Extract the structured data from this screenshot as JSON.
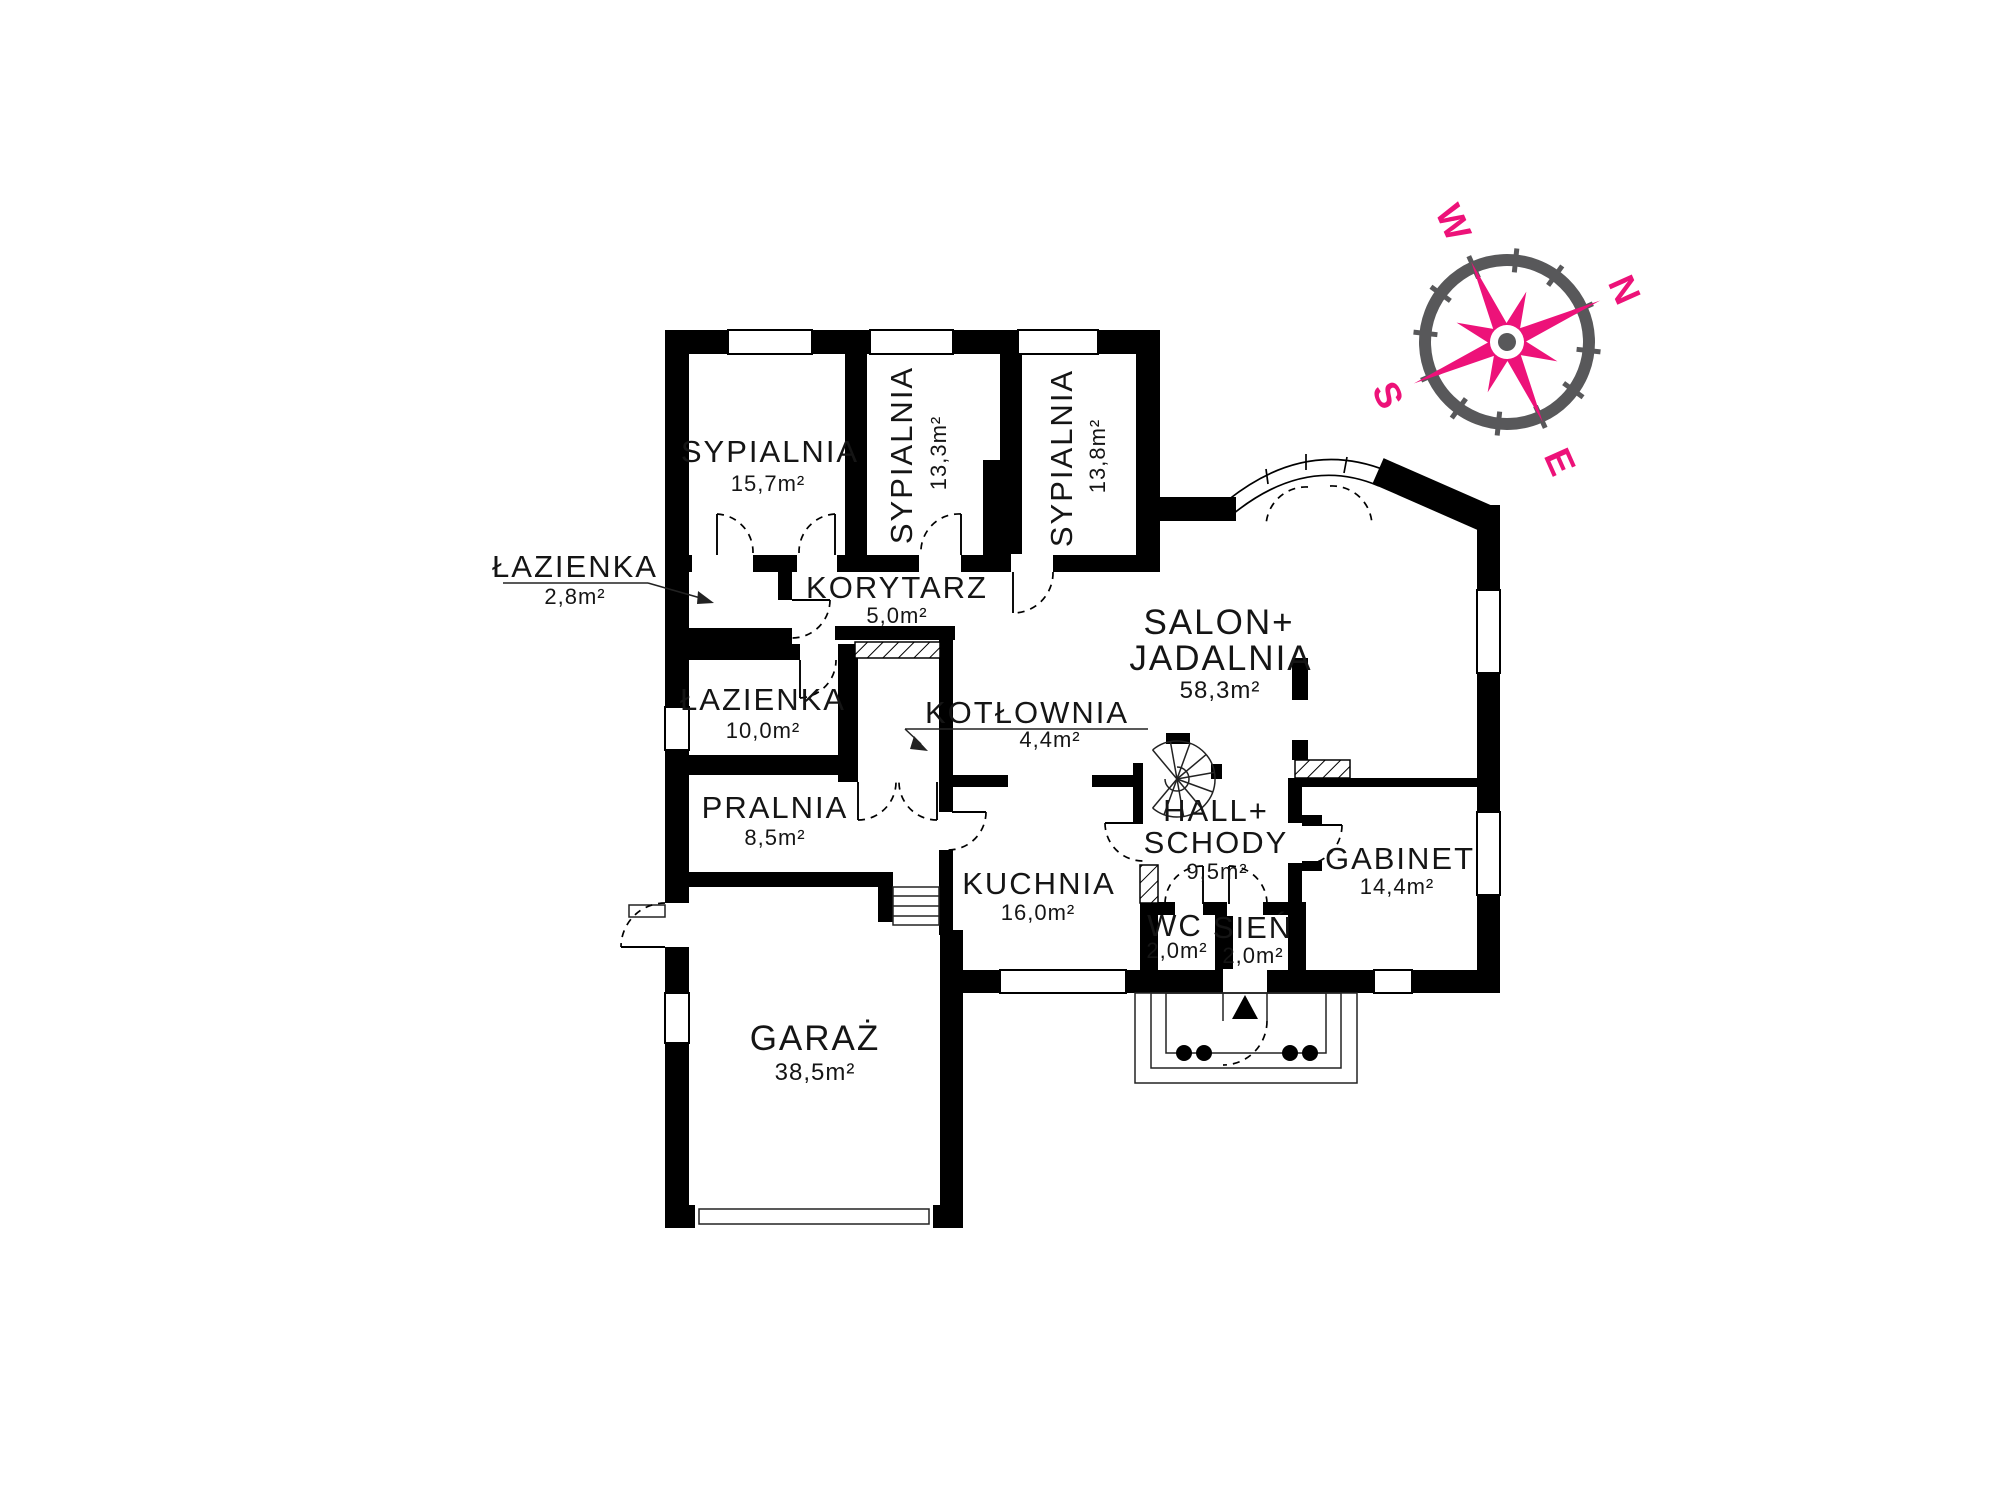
{
  "plan_title": "floor-plan",
  "rooms": {
    "bedroom1": {
      "name": "SYPIALNIA",
      "area": "15,7m²"
    },
    "bedroom2": {
      "name": "SYPIALNIA",
      "area": "13,3m²"
    },
    "bedroom3": {
      "name": "SYPIALNIA",
      "area": "13,8m²"
    },
    "bath_small": {
      "name": "ŁAZIENKA",
      "area": "2,8m²"
    },
    "corridor": {
      "name": "KORYTARZ",
      "area": "5,0m²"
    },
    "bathroom": {
      "name": "ŁAZIENKA",
      "area": "10,0m²"
    },
    "boiler": {
      "name": "KOTŁOWNIA",
      "area": "4,4m²"
    },
    "laundry": {
      "name": "PRALNIA",
      "area": "8,5m²"
    },
    "living": {
      "name_line1": "SALON+",
      "name_line2": "JADALNIA",
      "area": "58,3m²"
    },
    "kitchen": {
      "name": "KUCHNIA",
      "area": "16,0m²"
    },
    "hall": {
      "name_line1": "HALL+",
      "name_line2": "SCHODY",
      "area": "9,5m²"
    },
    "wc": {
      "name": "WC",
      "area": "2,0m²"
    },
    "vestibule": {
      "name": "SIEŃ",
      "area": "2,0m²"
    },
    "office": {
      "name": "GABINET",
      "area": "14,4m²"
    },
    "garage": {
      "name": "GARAŻ",
      "area": "38,5m²"
    }
  },
  "compass": {
    "north": "N",
    "east": "E",
    "south": "S",
    "west": "W",
    "needle_color": "#ED1279",
    "ring_color": "#58585A",
    "rotation_deg": 66
  },
  "colors": {
    "walls": "#000000",
    "background": "#ffffff",
    "text": "#151515"
  }
}
